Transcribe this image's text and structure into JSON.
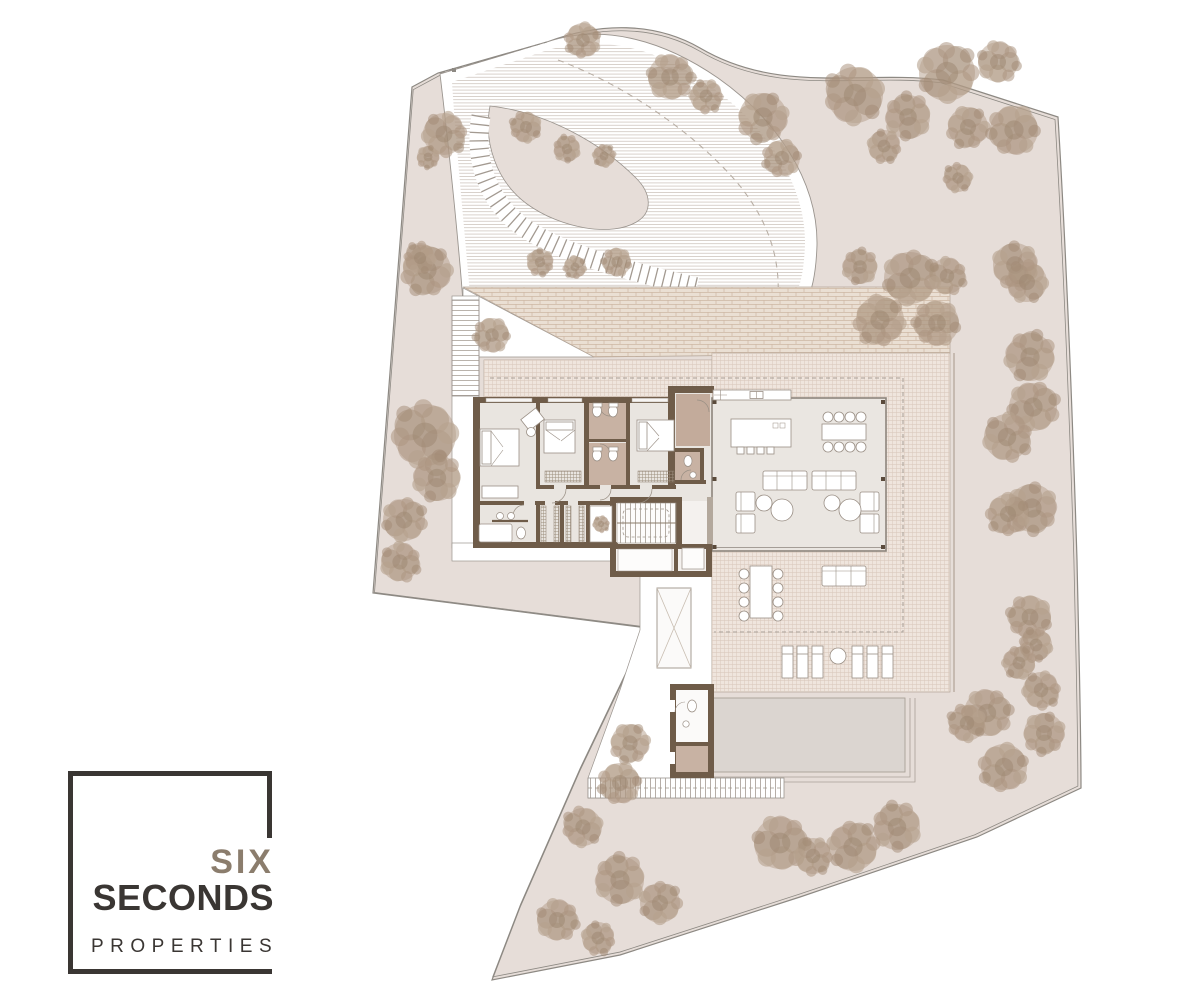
{
  "logo": {
    "line1": "SIX",
    "line2": "SECONDS",
    "line3": "PROPERTIES"
  },
  "palette": {
    "background": "#ffffff",
    "site_ground": "#e6ddd8",
    "wall_brown": "#6f5c49",
    "bath_floor": "#c8b2a3",
    "room_floor": "#eae6e1",
    "terrace_tile": "#efe5dd",
    "brick_paving": "#eadfd3",
    "pool_water": "#dbd5d0",
    "tree_foliage": "#b49e8a",
    "boundary_line": "#8d8983",
    "logo_dark": "#3a3633",
    "logo_taupe": "#8b7d6d"
  },
  "site": {
    "trees": [
      [
        444,
        134,
        21
      ],
      [
        428,
        157,
        11
      ],
      [
        583,
        40,
        17
      ],
      [
        526,
        127,
        15
      ],
      [
        567,
        149,
        13
      ],
      [
        604,
        156,
        11
      ],
      [
        670,
        77,
        22
      ],
      [
        706,
        96,
        16
      ],
      [
        763,
        117,
        24
      ],
      [
        782,
        158,
        18
      ],
      [
        855,
        95,
        28
      ],
      [
        908,
        117,
        22
      ],
      [
        947,
        73,
        28
      ],
      [
        998,
        62,
        20
      ],
      [
        884,
        146,
        16
      ],
      [
        968,
        127,
        20
      ],
      [
        1014,
        130,
        24
      ],
      [
        958,
        178,
        14
      ],
      [
        860,
        267,
        17
      ],
      [
        910,
        278,
        26
      ],
      [
        947,
        276,
        18
      ],
      [
        1015,
        265,
        22
      ],
      [
        880,
        320,
        24
      ],
      [
        937,
        323,
        22
      ],
      [
        1027,
        282,
        20
      ],
      [
        1030,
        357,
        24
      ],
      [
        1033,
        407,
        24
      ],
      [
        1007,
        437,
        23
      ],
      [
        1032,
        508,
        24
      ],
      [
        1008,
        514,
        20
      ],
      [
        1030,
        617,
        21
      ],
      [
        1036,
        645,
        16
      ],
      [
        1019,
        663,
        16
      ],
      [
        987,
        713,
        23
      ],
      [
        1041,
        690,
        18
      ],
      [
        1044,
        733,
        20
      ],
      [
        1004,
        767,
        23
      ],
      [
        967,
        723,
        18
      ],
      [
        897,
        827,
        23
      ],
      [
        853,
        847,
        24
      ],
      [
        780,
        843,
        26
      ],
      [
        813,
        856,
        18
      ],
      [
        630,
        743,
        19
      ],
      [
        620,
        783,
        20
      ],
      [
        583,
        827,
        19
      ],
      [
        620,
        880,
        24
      ],
      [
        660,
        903,
        20
      ],
      [
        557,
        920,
        20
      ],
      [
        598,
        938,
        16
      ],
      [
        427,
        270,
        24
      ],
      [
        492,
        335,
        17
      ],
      [
        425,
        435,
        31
      ],
      [
        437,
        478,
        23
      ],
      [
        404,
        520,
        21
      ],
      [
        400,
        562,
        19
      ],
      [
        540,
        262,
        13
      ],
      [
        575,
        267,
        11
      ],
      [
        617,
        262,
        14
      ],
      [
        420,
        258,
        15
      ]
    ],
    "planter_trees": [
      [
        601,
        524,
        8
      ]
    ]
  }
}
